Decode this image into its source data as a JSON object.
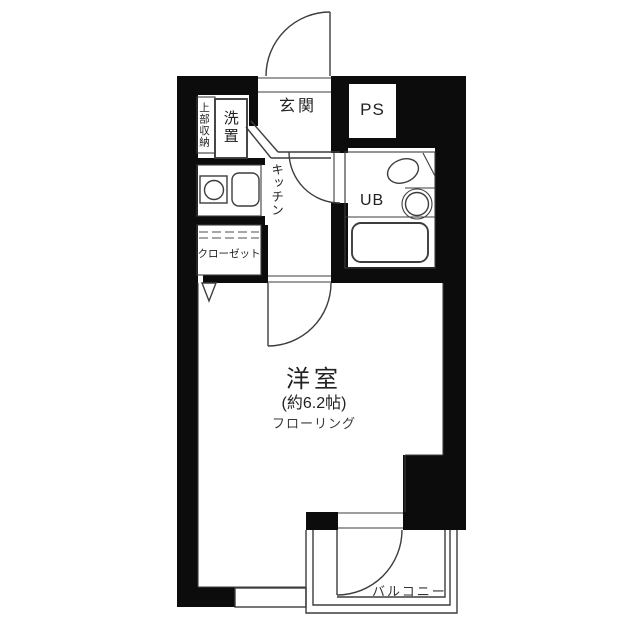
{
  "plan": {
    "entrance": {
      "label": "玄関"
    },
    "pipe_space": {
      "label": "PS"
    },
    "washer_place": {
      "label": "洗置"
    },
    "upper_storage": {
      "label": "上部収納"
    },
    "kitchen": {
      "label": "キッチン"
    },
    "unit_bath": {
      "label": "UB"
    },
    "closet": {
      "label": "クローゼット"
    },
    "main_room": {
      "label": "洋室",
      "size": "(約6.2帖)",
      "flooring": "フローリング"
    },
    "balcony": {
      "label": "バルコニー"
    }
  },
  "colors": {
    "wall": "#0c0c0c",
    "line": "#3d3d3d",
    "text": "#222222"
  }
}
